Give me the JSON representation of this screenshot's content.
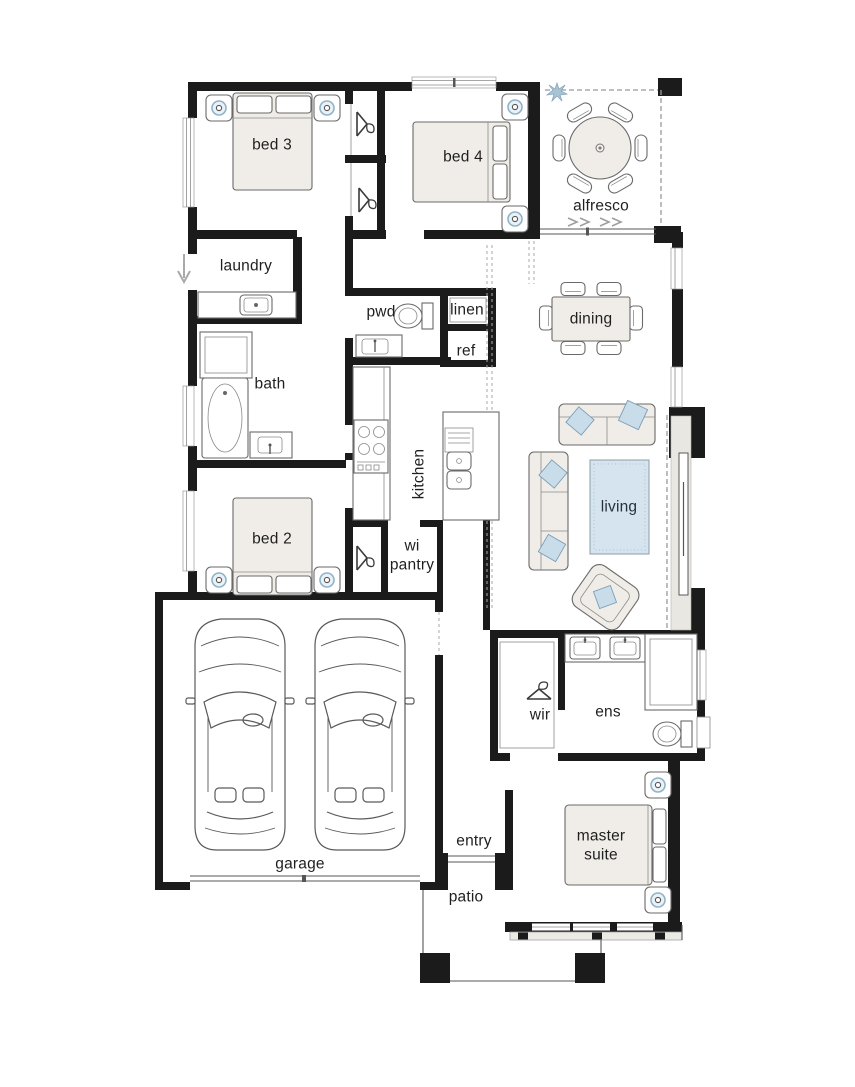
{
  "plan_title": "single storey house floor plan",
  "colors": {
    "wall": "#1b1b1b",
    "furniture_outline": "#6a6a6a",
    "furniture_fill": "#f0ede8",
    "accent_blue": "#c9dcea",
    "rug_blue": "#d5e4ef",
    "label_text": "#1f1f1f"
  },
  "rooms": {
    "bed3": {
      "label": "bed 3"
    },
    "bed4": {
      "label": "bed 4"
    },
    "alfresco": {
      "label": "alfresco"
    },
    "laundry": {
      "label": "laundry"
    },
    "pwd": {
      "label": "pwd"
    },
    "linen": {
      "label": "linen"
    },
    "ref": {
      "label": "ref"
    },
    "dining": {
      "label": "dining"
    },
    "bath": {
      "label": "bath"
    },
    "kitchen": {
      "label": "kitchen"
    },
    "bed2": {
      "label": "bed 2"
    },
    "wi_pantry": {
      "label": "wi pantry",
      "line1": "wi",
      "line2": "pantry"
    },
    "living": {
      "label": "living"
    },
    "wir": {
      "label": "wir"
    },
    "ens": {
      "label": "ens"
    },
    "garage": {
      "label": "garage"
    },
    "entry": {
      "label": "entry"
    },
    "master_suite": {
      "label": "master suite",
      "line1": "master",
      "line2": "suite"
    },
    "patio": {
      "label": "patio"
    }
  },
  "icons": {
    "wardrobe": "hanger-icon",
    "garden": "plant-icon",
    "sliding_door": "double-chevron-icon",
    "external_door": "down-arrow-icon"
  }
}
